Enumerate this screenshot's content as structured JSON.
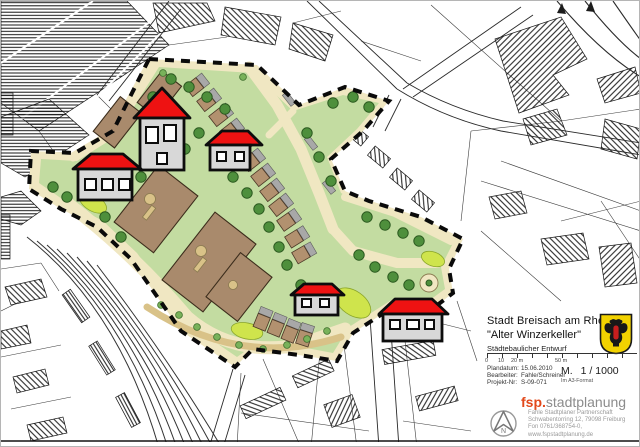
{
  "title_block": {
    "city": "Stadt Breisach am Rhein",
    "project": "\"Alter Winzerkeller\"",
    "subtitle": "Städtebaulicher Entwurf",
    "scale_bar_labels": [
      "0",
      "10",
      "20 m",
      "50 m"
    ],
    "meta_rows": [
      {
        "label": "Plandatum:",
        "value": "15.06.2010"
      },
      {
        "label": "Bearbeiter:",
        "value": "Fahle/Schreiner"
      },
      {
        "label": "Projekt-Nr:",
        "value": "S-09-071"
      }
    ],
    "scale_prefix": "M.",
    "scale_value": "1 / 1000",
    "format_note": "Im A3-Format",
    "logo_prefix": "fsp.",
    "logo_name": "stadtplanung",
    "address_lines": [
      "Fahle Stadtplaner Partnerschaft",
      "Schwabentorring 12, 79098 Freiburg",
      "Fon 0761/368754-0, www.fspstadtplanung.de"
    ],
    "north_label": "N"
  },
  "icons": {
    "crest": "breisach-coat-of-arms",
    "north_arrow": "north-arrow-icon",
    "house_marker": "red-roof-house-icon"
  },
  "colors": {
    "ink": "#1c1c1c",
    "site_green": "#c3dca1",
    "bright_green": "#cfe44c",
    "road_cream": "#f0e7c2",
    "path_tan": "#d9c288",
    "building_brown": "#a98a6c",
    "rowhouse_brown": "#b2916f",
    "driveway_gray": "#a8a8a8",
    "tree_green": "#4e8f3c",
    "tree_light": "#79b25a",
    "roof_red": "#ee1212",
    "house_gray": "#d8d8d8",
    "crest_gold": "#f2d200",
    "crest_red": "#c81e1e",
    "logo_red": "#e2491b",
    "logo_gray": "#8c8c8c"
  }
}
